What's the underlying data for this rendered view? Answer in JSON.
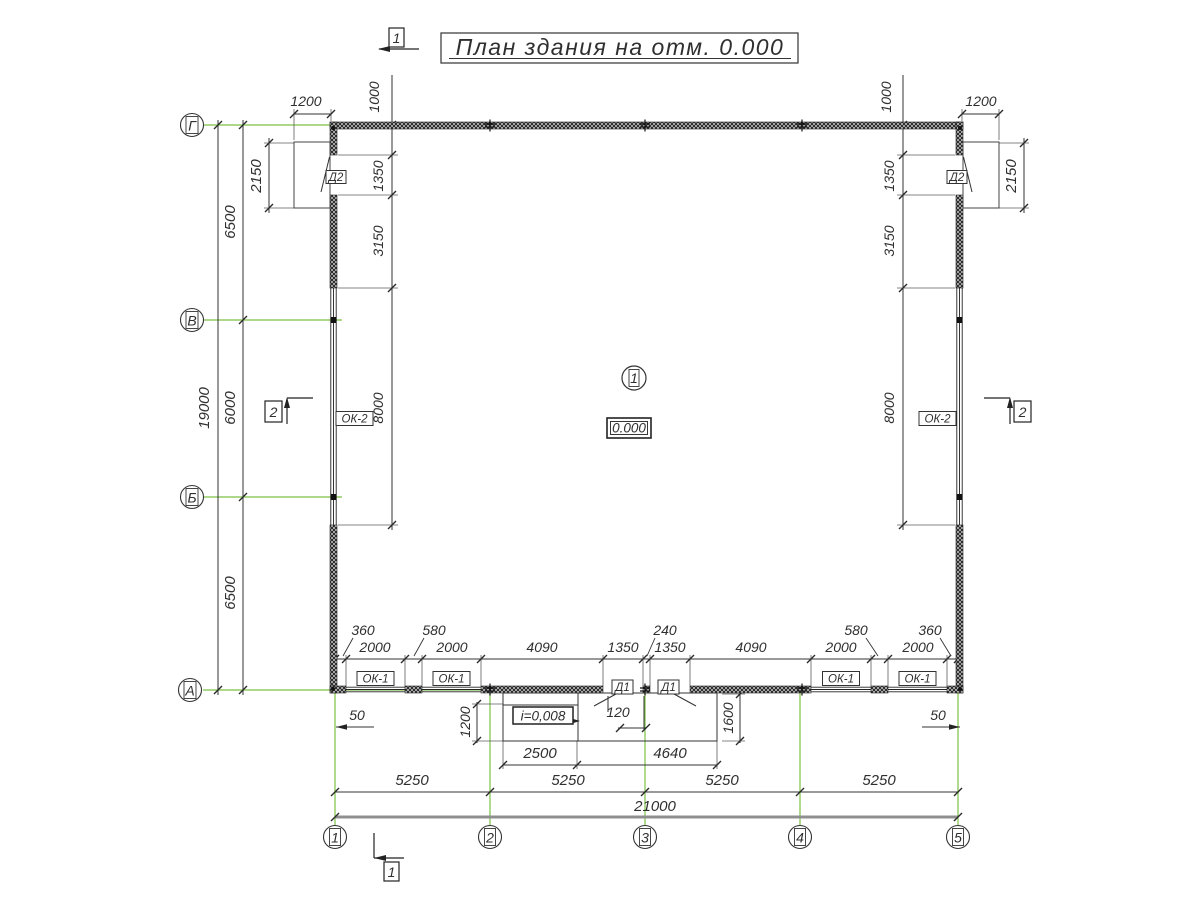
{
  "title": {
    "text": "План здания на отм. 0.000"
  },
  "room": {
    "number": "1",
    "elevation": "0.000"
  },
  "slope_label": "i=0,008",
  "axes": {
    "g": "Г",
    "v": "В",
    "b": "Б",
    "a": "А",
    "n1": "1",
    "n2": "2",
    "n3": "3",
    "n4": "4",
    "n5": "5"
  },
  "sections": {
    "s1": "1",
    "s2": "2"
  },
  "openings": {
    "window_small": "ОК-1",
    "window_large": "ОК-2",
    "door_inner": "Д1",
    "door_outer": "Д2"
  },
  "dims": {
    "overall_h": "19000",
    "span_gv": "6500",
    "span_vb": "6000",
    "span_ba": "6500",
    "porch_l_w": "1200",
    "porch_r_w": "1200",
    "porch_l_len": "2150",
    "porch_r_len": "2150",
    "wl_1000": "1000",
    "wr_1000": "1000",
    "wl_1350": "1350",
    "wr_1350": "1350",
    "wl_3150": "3150",
    "wr_3150": "3150",
    "wl_8000": "8000",
    "wr_8000": "8000",
    "b0": "360",
    "b1": "2000",
    "b2": "580",
    "b3": "2000",
    "b4": "4090",
    "b5": "1350",
    "b6": "240",
    "b7": "1350",
    "b8": "4090",
    "b9": "2000",
    "b10": "580",
    "b11": "2000",
    "b12": "360",
    "s12": "5250",
    "s23": "5250",
    "s34": "5250",
    "s45": "5250",
    "overall_w": "21000",
    "ramp_2500": "2500",
    "ramp_4640": "4640",
    "ramp_1200": "1200",
    "ramp_1600": "1600",
    "step_120": "120",
    "off_50_l": "50",
    "off_50_r": "50"
  },
  "colors": {
    "axis_green": "#7cc143",
    "ink": "#2f2f2f",
    "overall_dim_line": "#8f8f8f"
  }
}
